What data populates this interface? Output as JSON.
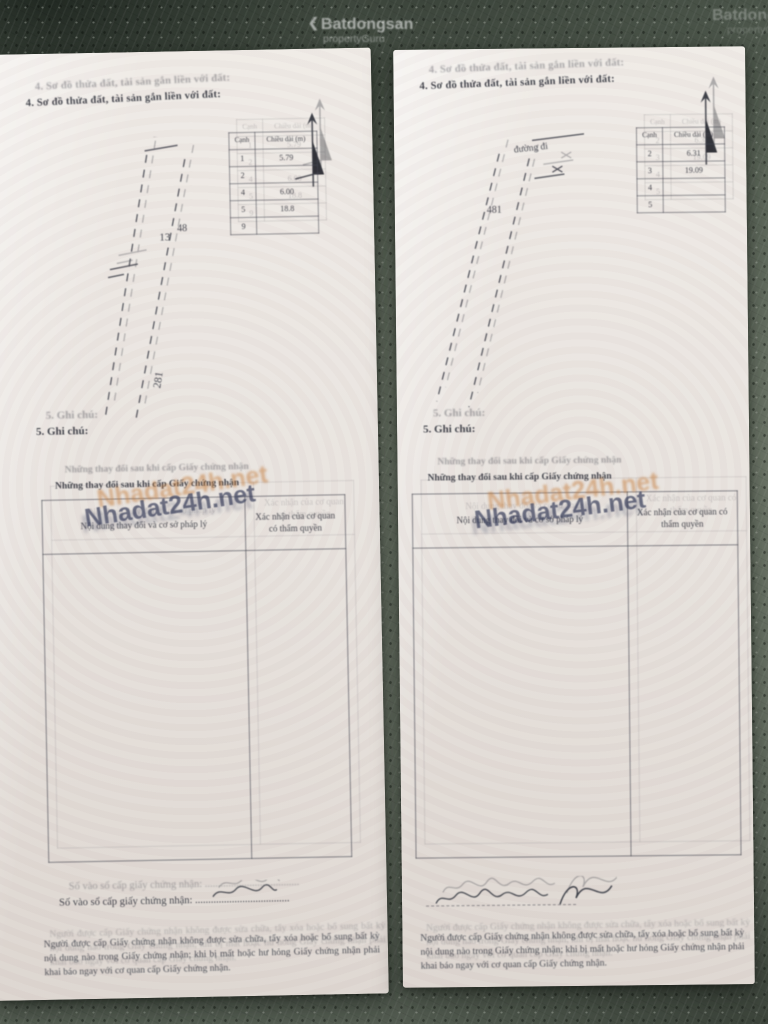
{
  "photo_watermarks": {
    "brand": "Batdongsan",
    "brand_sub": "propertyGuru",
    "brand_chevron": "❮",
    "site": "Nhadat24h.net"
  },
  "pages": [
    {
      "side": "left",
      "section4_heading": "4. Sơ đồ thửa đất, tài sản gắn liền với đất:",
      "diagram": {
        "label_parcel": "13",
        "label_small": "48",
        "label_vertical": "281",
        "edge_table": {
          "col_edge": "Cạnh",
          "col_length": "Chiều dài (m)",
          "rows": [
            [
              "1",
              "5.79"
            ],
            [
              "2",
              ""
            ],
            [
              "4",
              "6.00"
            ],
            [
              "5",
              "18.8"
            ],
            [
              "9",
              ""
            ]
          ]
        }
      },
      "section5_heading": "5. Ghi chú:",
      "changes_table": {
        "title": "Những thay đổi sau khi cấp Giấy chứng nhận",
        "col_content": "Nội dung thay đổi và cơ sở pháp lý",
        "col_confirm": "Xác nhận của cơ quan có thẩm quyền"
      },
      "footer": {
        "book_label": "Số vào sổ cấp giấy chứng nhận:",
        "book_dots": "....................................",
        "fine_print": "Người được cấp Giấy chứng nhận không được sửa chữa, tẩy xóa hoặc bổ sung bất kỳ nội dung nào trong Giấy chứng nhận; khi bị mất hoặc hư hỏng Giấy chứng nhận phải khai báo ngay với cơ quan cấp Giấy chứng nhận."
      }
    },
    {
      "side": "right",
      "section4_heading": "4. Sơ đồ thửa đất, tài sản gắn liền với đất:",
      "diagram": {
        "label_parcel": "481",
        "label_road": "đường đi",
        "edge_table": {
          "col_edge": "Cạnh",
          "col_length": "Chiều dài (m)",
          "rows": [
            [
              "2",
              "6.31"
            ],
            [
              "3",
              "19.09"
            ],
            [
              "4",
              ""
            ],
            [
              "5",
              ""
            ]
          ]
        }
      },
      "section5_heading": "5. Ghi chú:",
      "changes_table": {
        "title": "Những thay đổi sau khi cấp Giấy chứng nhận",
        "col_content": "Nội dung thay đổi và cơ sở pháp lý",
        "col_confirm": "Xác nhận của cơ quan có thẩm quyền"
      },
      "footer": {
        "fine_print": "Người được cấp Giấy chứng nhận không được sửa chữa, tẩy xóa hoặc bổ sung bất kỳ nội dung nào trong Giấy chứng nhận; khi bị mất hoặc hư hỏng Giấy chứng nhận phải khai báo ngay với cơ quan cấp Giấy chứng nhận."
      }
    }
  ],
  "colors": {
    "floor": "#66705f",
    "paper": "#e9e4df",
    "ink": "#41434b",
    "watermark_dark": "#3f4560",
    "watermark_orange": "#c07a3a"
  }
}
